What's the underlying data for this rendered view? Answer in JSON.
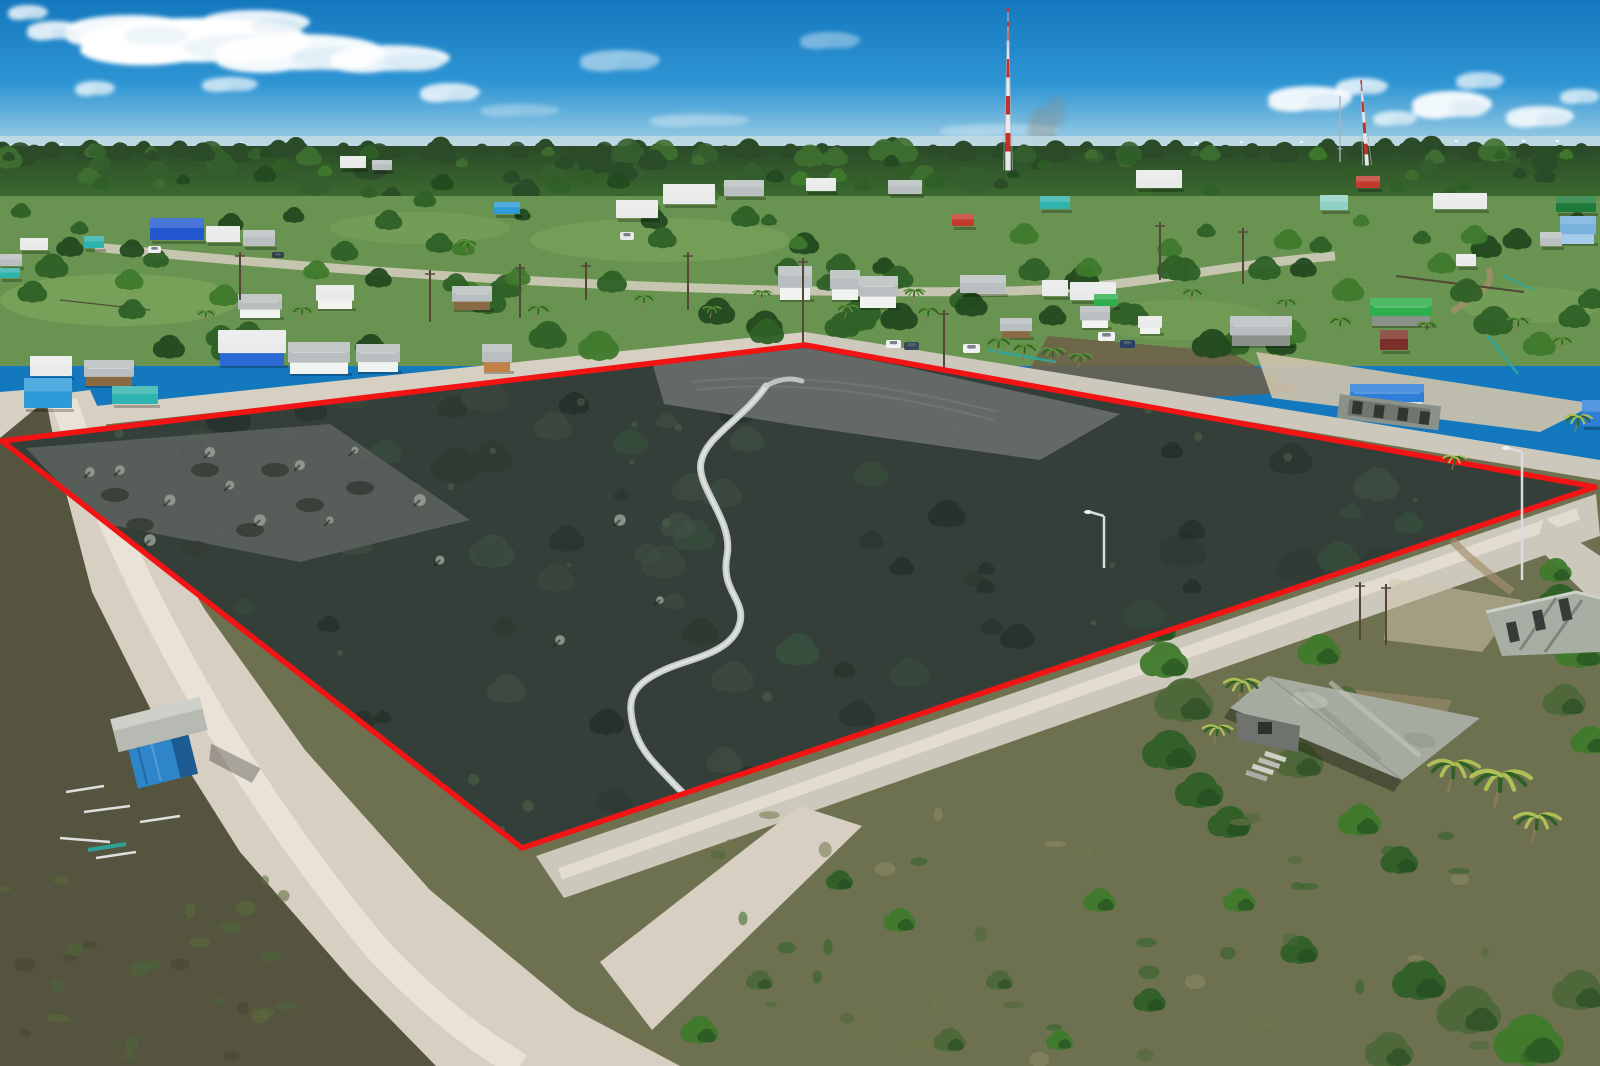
{
  "meta": {
    "description": "Aerial drone photograph of a vacant land parcel highlighted with a red boundary overlay, surrounded by sandy dirt roads, village houses, palm trees and scrubland under a blue sky",
    "width": 1600,
    "height": 1066
  },
  "palette": {
    "skyTop": "#1478be",
    "skyMid": "#2e95d4",
    "skyLow": "#8fc6e2",
    "horizonHaze": "#cfe2ea",
    "cloudWhite": "#ffffff",
    "seaBand": "#bfd9e2",
    "forestFar": "#2a4a28",
    "forestMid": "#35602e",
    "forestNear": "#3f7030",
    "grassTown": "#699350",
    "grassLight": "#7da75c",
    "treeDark": "#234a20",
    "treeMid": "#2f6026",
    "treeLight": "#3f7a2c",
    "palmGreen": "#5d9338",
    "palmYellow": "#aebf55",
    "parcelBase": "#333f38",
    "parcelDark": "#26302a",
    "parcelDeep": "#1f2823",
    "parcelLight": "#415147",
    "parcelGreen": "#3a5440",
    "clearGrey": "#676c69",
    "clearGrey2": "#5b615d",
    "boundaryRed": "#f21414",
    "roadSand": "#d7cfc1",
    "roadBright": "#ece6da",
    "roadGrey": "#cdc8bc",
    "roadDirty": "#b4ab99",
    "dirtBrown": "#6e5f49",
    "dirtLight": "#a28f6c",
    "sandLot": "#cfc3ab",
    "scrubBase": "#6e7150",
    "scrubDark": "#55543f",
    "scrubGreen": "#4d6838",
    "scrubOlive": "#72764b",
    "concrete": "#a8aea4",
    "concreteDark": "#8b9289",
    "roofGrey": "#b9bfc0",
    "roofWhite": "#e8ebea",
    "roofBlue": "#2f7fd8",
    "roofLightBlue": "#79b2dd",
    "roofTeal": "#2fb3ae",
    "roofGreen": "#2fae4e",
    "roofDarkGreen": "#1e7a38",
    "roofRed": "#c23a2c",
    "roofMint": "#8fd2c5",
    "roofMaroon": "#7c2f28",
    "wallWhite": "#f1f3f1",
    "wallBlue": "#2a6ad2",
    "wallRoyalBlue": "#2257cf",
    "wallWood": "#8a6a45",
    "wallOrange": "#bf8148",
    "wallLightBlue": "#a4cbe8",
    "tarpBlue": "#2e9ad8",
    "towerRed": "#c23028",
    "towerWhite": "#e9e9e9",
    "steel": "#aab2ba",
    "poleBrown": "#55463a",
    "lampGrey": "#dadddb",
    "shackBlue": "#2e86c8",
    "shackBlueDark": "#1d5c93",
    "shackRoof": "#b6bab2",
    "derelictRoof": "#a6aba0",
    "derelictDark": "#8d938a",
    "derelictLight": "#c3c7bb",
    "wallGreyDark": "#6e746d",
    "pathGrey": "#c6cbc9",
    "pathBright": "#e3e7e5",
    "debrisWhite": "#edf0f1",
    "fenceTeal": "#2aa9a0",
    "fenceDark": "#4a3f33",
    "smoke": "#8d8273"
  },
  "geometry": {
    "parcel_outline": "2,441 805,345 1595,487 522,848",
    "nw_road": "0,416 805,332 805,348 0,436",
    "ne_road": "805,332 1600,460 1600,480 805,348",
    "sw_road": "44,396 90,390 140,500 205,610 305,750 430,890 575,1010 680,1066 430,1066 345,975 235,850 148,710 88,590 56,470",
    "sw_center": "M64,402 C120,560 220,762 380,952 C440,1014 480,1042 520,1066",
    "se_road": "536,856 1596,494 1600,536 564,898",
    "se_center": "M560,874 L1578,514",
    "se_branch": "600,962 800,806 862,826 652,1030",
    "se_cont": "1544,518 1600,556 1600,608 1536,546",
    "back_street": "M95,247 C380,276 720,296 1010,291 C1140,288 1210,266 1335,256",
    "corner_sand": "0,392 72,386 58,468 0,452",
    "sand_lot": "1256,352 1596,404 1540,432 1272,398",
    "dirt_patch": "1048,336 1230,352 1302,392 1124,402 1030,368",
    "spur": "M1488,268 C1498,288 1472,296 1452,312",
    "track_spur2": "M1452,540 C1470,560 1492,576 1512,592",
    "sand_patch1": "1390,578 1522,600 1482,652 1384,640",
    "sand_patch2": "1340,688 1452,700 1432,746 1348,736",
    "scrub_base": "0,430 805,344 1600,474 1600,1066 0,1066",
    "scrub_left": "0,438 46,400 60,470 92,592 152,712 240,852 350,978 436,1066 0,1066",
    "cleared_top": "652,362 806,348 902,366 1120,414 1040,460 800,426 664,404",
    "cleared_left": "26,448 330,424 470,520 300,562 96,522",
    "trail_main": "M766,386 C742,420 706,436 701,462 C696,488 734,520 727,556 C720,592 748,600 739,626 C729,654 690,658 664,670 C640,681 629,692 631,712 C634,748 656,764 674,784 L692,802",
    "trail_fork": "M766,386 C778,379 790,377 802,381",
    "tire1": "M692,382 C780,372 880,382 998,412",
    "tire2": "M696,390 C782,380 878,390 994,420",
    "derelict_roof": "1268,676 1480,718 1402,780 1230,708",
    "derelict_eave": "1230,708 1402,780 1394,792 1224,718",
    "derelict_wall": "1236,712 1300,726 1298,752 1238,740",
    "unfinished1": "1486,612 1576,592 1600,598 1600,652 1502,656"
  },
  "scene": {
    "seed": 11,
    "counts": {
      "town_trees": 120,
      "parcel_blobs": 150,
      "parcel_tufts": 30,
      "scrub_tufts_left": 28,
      "scrub_tufts_right": 48,
      "forest_blobs": 75
    },
    "clouds": [
      [
        195,
        40,
        115,
        22,
        1
      ],
      [
        300,
        52,
        85,
        18,
        0.95
      ],
      [
        130,
        30,
        65,
        15,
        0.95
      ],
      [
        255,
        22,
        55,
        12,
        0.9
      ],
      [
        390,
        58,
        60,
        13,
        0.9
      ],
      [
        55,
        30,
        28,
        9,
        0.85
      ],
      [
        450,
        92,
        30,
        9,
        0.8
      ],
      [
        95,
        88,
        20,
        7,
        0.75
      ],
      [
        28,
        12,
        20,
        7,
        0.8
      ],
      [
        230,
        84,
        28,
        7,
        0.7
      ],
      [
        620,
        60,
        40,
        10,
        0.5
      ],
      [
        830,
        40,
        30,
        8,
        0.4
      ],
      [
        1310,
        98,
        42,
        12,
        0.9
      ],
      [
        1362,
        86,
        26,
        8,
        0.8
      ],
      [
        1452,
        104,
        40,
        13,
        0.92
      ],
      [
        1540,
        116,
        34,
        10,
        0.85
      ],
      [
        1480,
        80,
        24,
        8,
        0.7
      ],
      [
        1395,
        118,
        22,
        7,
        0.7
      ],
      [
        1580,
        96,
        20,
        7,
        0.7
      ],
      [
        700,
        120,
        50,
        6,
        0.35
      ],
      [
        1000,
        130,
        60,
        6,
        0.3
      ],
      [
        520,
        110,
        40,
        6,
        0.3
      ]
    ],
    "sea_dots": [
      [
        60,
        143
      ],
      [
        120,
        142
      ],
      [
        240,
        142
      ],
      [
        1195,
        142
      ],
      [
        1240,
        141
      ],
      [
        1300,
        141
      ],
      [
        1455,
        140
      ],
      [
        1490,
        140
      ],
      [
        1522,
        140
      ],
      [
        1556,
        140
      ]
    ],
    "field_patches": [
      [
        120,
        300,
        120,
        26,
        "grassLight",
        0.7
      ],
      [
        660,
        240,
        130,
        22,
        "grassLight",
        0.55
      ],
      [
        1530,
        305,
        70,
        18,
        "grassLight",
        0.5
      ],
      [
        420,
        228,
        90,
        16,
        "grassLight",
        0.5
      ],
      [
        1180,
        320,
        90,
        20,
        "grassLight",
        0.4
      ]
    ],
    "houses": [
      [
        340,
        156,
        26,
        12,
        "roofWhite",
        null
      ],
      [
        372,
        160,
        20,
        10,
        "roofGrey",
        null
      ],
      [
        494,
        202,
        26,
        12,
        "tarpBlue",
        null
      ],
      [
        616,
        200,
        42,
        18,
        "roofWhite",
        null
      ],
      [
        663,
        184,
        52,
        20,
        "roofWhite",
        null
      ],
      [
        724,
        180,
        40,
        16,
        "roofGrey",
        null
      ],
      [
        806,
        178,
        30,
        13,
        "roofWhite",
        null
      ],
      [
        888,
        180,
        34,
        14,
        "roofGrey",
        null
      ],
      [
        952,
        214,
        22,
        12,
        "roofRed",
        null
      ],
      [
        1040,
        196,
        30,
        13,
        "roofTeal",
        null
      ],
      [
        1136,
        170,
        46,
        18,
        "roofWhite",
        null
      ],
      [
        1320,
        195,
        28,
        15,
        "roofMint",
        null
      ],
      [
        1356,
        176,
        24,
        12,
        "roofRed",
        null
      ],
      [
        1433,
        193,
        54,
        16,
        "roofWhite",
        null
      ],
      [
        1556,
        196,
        40,
        16,
        "roofDarkGreen",
        null
      ],
      [
        150,
        218,
        54,
        22,
        "wallRoyalBlue",
        null
      ],
      [
        206,
        226,
        34,
        16,
        "roofWhite",
        null
      ],
      [
        243,
        230,
        32,
        16,
        "roofGrey",
        null
      ],
      [
        84,
        236,
        20,
        12,
        "roofTeal",
        null
      ],
      [
        20,
        238,
        28,
        12,
        "roofWhite",
        null
      ],
      [
        0,
        254,
        22,
        12,
        "roofGrey",
        null
      ],
      [
        0,
        268,
        20,
        10,
        "roofTeal",
        null
      ],
      [
        238,
        294,
        44,
        22,
        "roofGrey",
        "wallWhite"
      ],
      [
        316,
        285,
        38,
        22,
        "roofWhite",
        "wallWhite"
      ],
      [
        452,
        286,
        40,
        22,
        "roofGrey",
        "wallWood"
      ],
      [
        218,
        330,
        68,
        34,
        "roofWhite",
        "wallBlue"
      ],
      [
        288,
        342,
        62,
        30,
        "roofGrey",
        "wallWhite"
      ],
      [
        356,
        344,
        44,
        26,
        "roofGrey",
        "wallWhite"
      ],
      [
        482,
        344,
        30,
        26,
        "roofGrey",
        "wallOrange"
      ],
      [
        30,
        356,
        42,
        20,
        "roofWhite",
        null
      ],
      [
        24,
        378,
        48,
        30,
        "tarpBlue",
        null
      ],
      [
        84,
        360,
        50,
        24,
        "roofGrey",
        "wallWood"
      ],
      [
        112,
        386,
        46,
        18,
        "roofTeal",
        null
      ],
      [
        778,
        266,
        34,
        32,
        "roofGrey",
        "wallWhite"
      ],
      [
        830,
        270,
        30,
        28,
        "roofGrey",
        "wallWhite"
      ],
      [
        858,
        276,
        40,
        30,
        "roofGrey",
        "wallWhite"
      ],
      [
        960,
        275,
        46,
        18,
        "roofGrey",
        null
      ],
      [
        1042,
        280,
        26,
        16,
        "roofWhite",
        null
      ],
      [
        1070,
        282,
        46,
        18,
        "roofWhite",
        null
      ],
      [
        1094,
        294,
        24,
        12,
        "roofGreen",
        null
      ],
      [
        1080,
        306,
        30,
        20,
        "roofGrey",
        "wallWhite"
      ],
      [
        1000,
        318,
        32,
        18,
        "roofGrey",
        "wallWood"
      ],
      [
        1138,
        316,
        24,
        16,
        "roofWhite",
        "wallWhite"
      ],
      [
        1230,
        316,
        62,
        28,
        "roofGrey",
        "concreteDark"
      ],
      [
        1370,
        298,
        62,
        26,
        "roofGreen",
        "concreteDark"
      ],
      [
        1380,
        330,
        28,
        20,
        "roofMaroon",
        null
      ],
      [
        1350,
        384,
        74,
        26,
        "roofBlue",
        "wallWhite"
      ],
      [
        1560,
        216,
        36,
        26,
        "roofLightBlue",
        "wallLightBlue"
      ],
      [
        1540,
        232,
        22,
        14,
        "roofGrey",
        null
      ],
      [
        1456,
        254,
        20,
        12,
        "roofWhite",
        null
      ],
      [
        1582,
        400,
        18,
        26,
        "roofBlue",
        null
      ]
    ],
    "towers": [
      [
        1008,
        22,
        170,
        "lattice"
      ],
      [
        1340,
        96,
        162,
        "thin"
      ],
      [
        1367,
        80,
        165,
        "lattice-small"
      ]
    ],
    "cars": [
      [
        886,
        340,
        15,
        8,
        "#f2f2f2"
      ],
      [
        904,
        342,
        15,
        8,
        "#384a5a"
      ],
      [
        963,
        344,
        17,
        9,
        "#f2f2f2"
      ],
      [
        1098,
        332,
        17,
        9,
        "#f2f2f2"
      ],
      [
        1120,
        340,
        15,
        8,
        "#2a3f66"
      ],
      [
        148,
        246,
        13,
        7,
        "#f0f0f0"
      ],
      [
        620,
        232,
        14,
        8,
        "#e8e8e8"
      ],
      [
        272,
        252,
        12,
        6,
        "#30404a"
      ]
    ],
    "utility_poles": [
      [
        803,
        258,
        348
      ],
      [
        944,
        310,
        368
      ],
      [
        688,
        252,
        310
      ],
      [
        520,
        264,
        318
      ],
      [
        430,
        270,
        322
      ],
      [
        240,
        252,
        300
      ],
      [
        1160,
        222,
        280
      ],
      [
        1243,
        228,
        284
      ],
      [
        1360,
        582,
        640
      ],
      [
        1386,
        584,
        645
      ],
      [
        586,
        262,
        300
      ]
    ],
    "lamp_posts": [
      [
        1522,
        448,
        580
      ],
      [
        1104,
        512,
        568
      ]
    ],
    "palms_town": [
      [
        912,
        302,
        9
      ],
      [
        926,
        322,
        10
      ],
      [
        536,
        320,
        10
      ],
      [
        642,
        308,
        9
      ],
      [
        300,
        320,
        9
      ],
      [
        466,
        252,
        8
      ],
      [
        760,
        302,
        8
      ],
      [
        996,
        354,
        11
      ],
      [
        1022,
        360,
        11
      ],
      [
        1050,
        364,
        11
      ],
      [
        1078,
        368,
        10
      ],
      [
        1190,
        302,
        9
      ],
      [
        1284,
        312,
        9
      ],
      [
        1338,
        332,
        10
      ],
      [
        204,
        322,
        8
      ],
      [
        1516,
        332,
        10
      ],
      [
        845,
        318,
        9
      ],
      [
        710,
        318,
        8
      ],
      [
        1425,
        335,
        9
      ],
      [
        1560,
        350,
        9
      ]
    ],
    "palms_large": [
      [
        1448,
        792,
        22
      ],
      [
        1494,
        808,
        26
      ],
      [
        1532,
        842,
        20
      ],
      [
        1238,
        702,
        16
      ],
      [
        1214,
        744,
        13
      ],
      [
        1575,
        432,
        12
      ],
      [
        1452,
        470,
        10
      ]
    ],
    "bushes": [
      [
        1165,
        660,
        18
      ],
      [
        1185,
        700,
        22
      ],
      [
        1170,
        750,
        20
      ],
      [
        1200,
        790,
        18
      ],
      [
        1230,
        822,
        16
      ],
      [
        1158,
        628,
        14
      ],
      [
        1560,
        600,
        16
      ],
      [
        1580,
        650,
        18
      ],
      [
        1565,
        700,
        16
      ],
      [
        1590,
        740,
        14
      ],
      [
        1556,
        570,
        12
      ],
      [
        1420,
        980,
        20
      ],
      [
        1470,
        1010,
        24
      ],
      [
        1530,
        1040,
        26
      ],
      [
        1580,
        990,
        20
      ],
      [
        1390,
        1050,
        18
      ],
      [
        1320,
        650,
        16
      ],
      [
        1345,
        700,
        14
      ],
      [
        1300,
        760,
        18
      ],
      [
        1360,
        820,
        16
      ],
      [
        1400,
        860,
        14
      ],
      [
        700,
        1030,
        14
      ],
      [
        760,
        980,
        10
      ],
      [
        900,
        920,
        12
      ],
      [
        1000,
        980,
        10
      ],
      [
        840,
        880,
        10
      ],
      [
        1100,
        900,
        12
      ],
      [
        950,
        1040,
        12
      ],
      [
        1060,
        1040,
        10
      ],
      [
        1240,
        900,
        12
      ],
      [
        1300,
        950,
        14
      ],
      [
        1150,
        1000,
        12
      ]
    ],
    "dead_trees": [
      [
        120,
        470
      ],
      [
        170,
        500
      ],
      [
        230,
        485
      ],
      [
        300,
        465
      ],
      [
        355,
        450
      ],
      [
        260,
        520
      ],
      [
        150,
        540
      ],
      [
        90,
        472
      ],
      [
        330,
        520
      ],
      [
        210,
        452
      ],
      [
        420,
        500
      ],
      [
        440,
        560
      ],
      [
        620,
        520
      ],
      [
        660,
        600
      ],
      [
        560,
        640
      ]
    ],
    "mounds": [
      [
        140,
        525
      ],
      [
        195,
        548
      ],
      [
        250,
        530
      ],
      [
        310,
        505
      ],
      [
        360,
        488
      ],
      [
        115,
        495
      ],
      [
        205,
        470
      ],
      [
        275,
        470
      ]
    ],
    "fences": [
      [
        988,
        350,
        1056,
        362,
        "fenceTeal",
        2.5
      ],
      [
        1488,
        336,
        1518,
        374,
        "fenceTeal",
        2.5
      ],
      [
        1504,
        276,
        1534,
        290,
        "fenceTeal",
        2
      ],
      [
        1396,
        276,
        1524,
        292,
        "fenceDark",
        2
      ],
      [
        60,
        300,
        150,
        310,
        "fenceDark",
        1.2
      ]
    ],
    "debris": [
      [
        66,
        792,
        104,
        786
      ],
      [
        84,
        812,
        130,
        806
      ],
      [
        60,
        838,
        110,
        842
      ],
      [
        140,
        822,
        180,
        816
      ],
      [
        96,
        858,
        136,
        852
      ]
    ]
  }
}
